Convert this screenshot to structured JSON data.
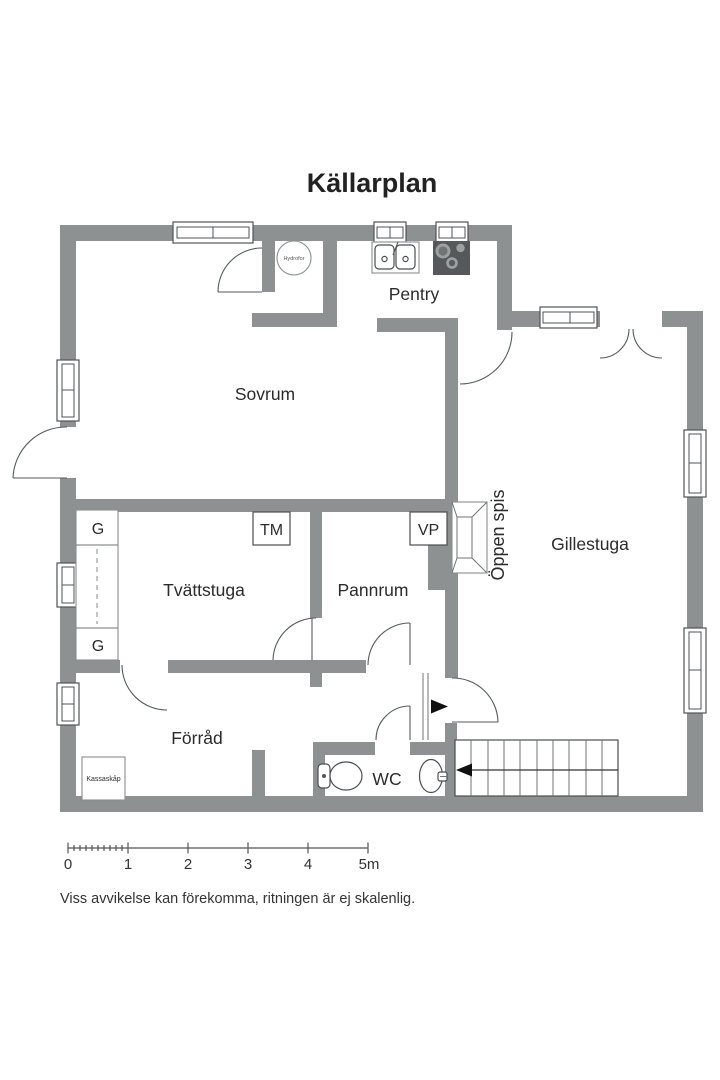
{
  "title": "Källarplan",
  "rooms": {
    "sovrum": "Sovrum",
    "pentry": "Pentry",
    "gillestuga": "Gillestuga",
    "tvattstuga": "Tvättstuga",
    "pannrum": "Pannrum",
    "forrad": "Förråd",
    "wc": "WC"
  },
  "features": {
    "oppen_spis": "Öppen spis",
    "hydrofor": "Hydrofor",
    "kassaskap": "Kassaskåp",
    "tm": "TM",
    "vp": "VP",
    "g_top": "G",
    "g_bottom": "G"
  },
  "scale_bar": {
    "ticks": [
      "0",
      "1",
      "2",
      "3",
      "4",
      "5m"
    ]
  },
  "disclaimer": "Viss avvikelse kan förekomma, ritningen är ej skalenlig.",
  "colors": {
    "wall": "#8d9191",
    "stove": "#55595b",
    "text": "#2b2b2b"
  }
}
